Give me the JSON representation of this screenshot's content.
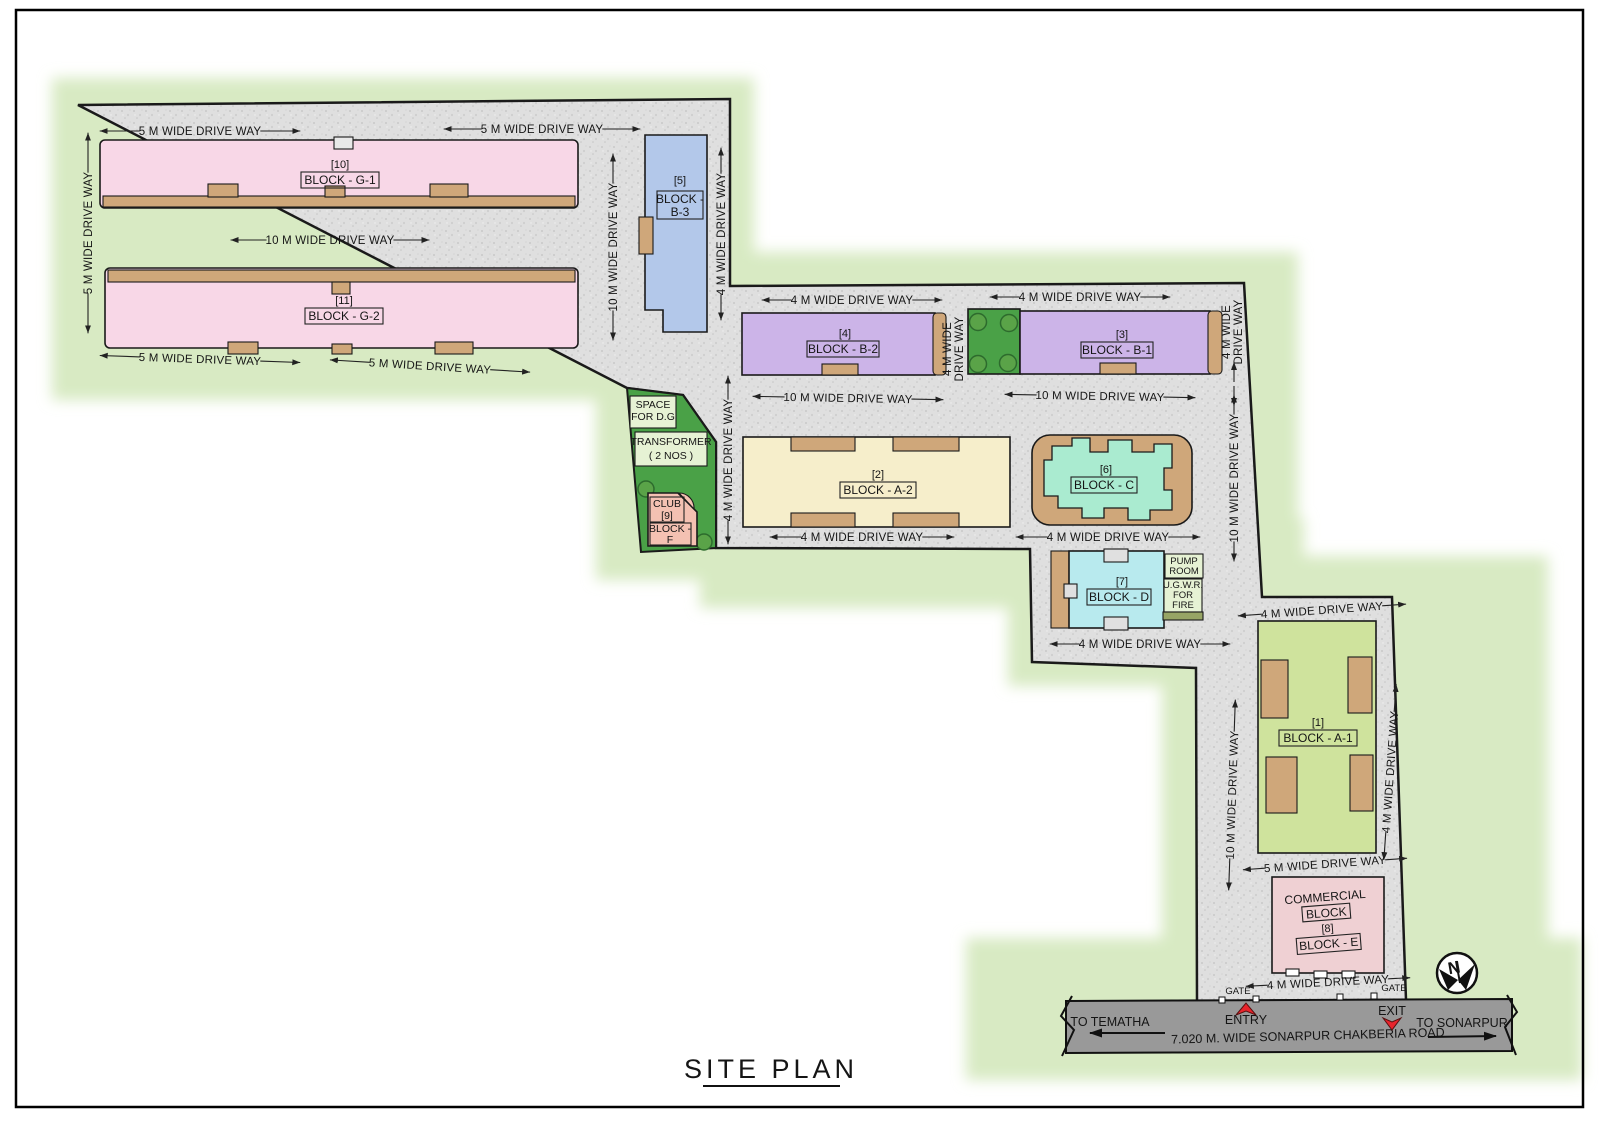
{
  "title": "SITE PLAN",
  "compass": {
    "north": "N"
  },
  "road": {
    "name": "7.020 M. WIDE SONARPUR CHAKBERIA ROAD",
    "to_left": "TO TEMATHA",
    "to_right": "TO SONARPUR",
    "entry": "ENTRY",
    "exit": "EXIT",
    "gate": "GATE"
  },
  "blocks": [
    {
      "key": "g1",
      "number": "[10]",
      "name": "BLOCK - G-1",
      "color": "#f8d7e7"
    },
    {
      "key": "g2",
      "number": "[11]",
      "name": "BLOCK - G-2",
      "color": "#f8d7e7"
    },
    {
      "key": "b3",
      "number": "[5]",
      "name_line1": "BLOCK -",
      "name_line2": "B-3",
      "color": "#b3c8ea"
    },
    {
      "key": "b2",
      "number": "[4]",
      "name": "BLOCK - B-2",
      "color": "#ccb4e8"
    },
    {
      "key": "b1",
      "number": "[3]",
      "name": "BLOCK - B-1",
      "color": "#ccb4e8"
    },
    {
      "key": "a2",
      "number": "[2]",
      "name": "BLOCK - A-2",
      "color": "#f6eecb"
    },
    {
      "key": "c",
      "number": "[6]",
      "name": "BLOCK - C",
      "color": "#aaebd0"
    },
    {
      "key": "d",
      "number": "[7]",
      "name": "BLOCK - D",
      "color": "#b8eaee"
    },
    {
      "key": "a1",
      "number": "[1]",
      "name": "BLOCK - A-1",
      "color": "#cfe39d"
    },
    {
      "key": "e",
      "heading": "COMMERCIAL",
      "subheading": "BLOCK",
      "number": "[8]",
      "name": "BLOCK - E",
      "color": "#efd0d3"
    },
    {
      "key": "f",
      "club": "CLUB",
      "number": "[9]",
      "name_line1": "BLOCK -",
      "name_line2": "F",
      "color": "#f4c1b2"
    }
  ],
  "facilities": {
    "space_dg": [
      "SPACE",
      "FOR D.G"
    ],
    "transformer": [
      "TRANSFORMER",
      "( 2 NOS )"
    ],
    "pump_room": [
      "PUMP",
      "ROOM"
    ],
    "ugwr": [
      "U.G.W.R.",
      "FOR",
      "FIRE"
    ]
  },
  "driveways": [
    {
      "t": "5 M WIDE DRIVE WAY",
      "x": 200,
      "y": 131,
      "r": 0,
      "a": 40
    },
    {
      "t": "5 M WIDE DRIVE WAY",
      "x": 542,
      "y": 129,
      "r": 0,
      "a": 38
    },
    {
      "t": "5 M WIDE DRIVE WAY",
      "x": 88,
      "y": 233,
      "r": -90,
      "a": 40
    },
    {
      "t": "10 M WIDE DRIVE WAY",
      "x": 330,
      "y": 240,
      "r": 0,
      "a": 36
    },
    {
      "t": "5 M WIDE DRIVE WAY",
      "x": 200,
      "y": 359,
      "r": 2,
      "a": 40
    },
    {
      "t": "5 M WIDE DRIVE WAY",
      "x": 430,
      "y": 366,
      "r": 3.5,
      "a": 40
    },
    {
      "t": "10 M WIDE DRIVE WAY",
      "x": 613,
      "y": 247,
      "r": -90,
      "a": 30
    },
    {
      "t": "4 M WIDE DRIVE WAY",
      "x": 721,
      "y": 234,
      "r": -90,
      "a": 26
    },
    {
      "t": "4 M WIDE DRIVE WAY",
      "x": 852,
      "y": 300,
      "r": 0,
      "a": 30
    },
    {
      "t": "4 M WIDE DRIVE WAY",
      "x": 1080,
      "y": 297,
      "r": 0,
      "a": 30
    },
    {
      "t": "4 M WIDE\nDRIVE WAY",
      "x": 953,
      "y": 349,
      "r": -90,
      "a": 0,
      "fs": 10.5
    },
    {
      "t": "4 M WIDE\nDRIVE WAY",
      "x": 1232,
      "y": 332,
      "r": -90,
      "a": 0,
      "fs": 10.5
    },
    {
      "t": "",
      "x": 1234,
      "y": 384,
      "r": -90,
      "a": 20
    },
    {
      "t": "10 M WIDE DRIVE WAY",
      "x": 848,
      "y": 398,
      "r": 1,
      "a": 32
    },
    {
      "t": "10 M WIDE DRIVE WAY",
      "x": 1100,
      "y": 396,
      "r": 1,
      "a": 32
    },
    {
      "t": "4 M WIDE DRIVE WAY",
      "x": 728,
      "y": 460,
      "r": -90,
      "a": 24
    },
    {
      "t": "10 M WIDE DRIVE WAY",
      "x": 1234,
      "y": 478,
      "r": -90,
      "a": 20
    },
    {
      "t": "4 M WIDE DRIVE WAY",
      "x": 862,
      "y": 537,
      "r": 0,
      "a": 32
    },
    {
      "t": "4 M WIDE DRIVE WAY",
      "x": 1108,
      "y": 537,
      "r": 0,
      "a": 32
    },
    {
      "t": "4 M WIDE DRIVE WAY",
      "x": 1140,
      "y": 644,
      "r": 0,
      "a": 30
    },
    {
      "t": "4 M WIDE DRIVE WAY",
      "x": 1322,
      "y": 610,
      "r": -4,
      "a": 24
    },
    {
      "t": "10 M WIDE DRIVE WAY",
      "x": 1232,
      "y": 795,
      "r": -88,
      "a": 32
    },
    {
      "t": "4 M WIDE DRIVE WAY",
      "x": 1390,
      "y": 772,
      "r": -86,
      "a": 28
    },
    {
      "t": "5 M WIDE DRIVE WAY",
      "x": 1325,
      "y": 864,
      "r": -4,
      "a": 22
    },
    {
      "t": "4 M WIDE DRIVE WAY",
      "x": 1328,
      "y": 982,
      "r": -3,
      "a": 22
    }
  ],
  "colors": {
    "paving": "#dedede",
    "buffer": "#d8eac3",
    "grass": "#4aa147",
    "tan": "#cfa77a",
    "pink": "#f8d7e7",
    "salmon": "#f4c1b2",
    "blue": "#b3c8ea",
    "purple": "#ccb4e8",
    "cream": "#f6eecb",
    "mint": "#aaebd0",
    "cyan": "#b8eaee",
    "lime": "#cfe39d",
    "pink_commercial": "#efd0d3",
    "utility_box": "#e6f2d4",
    "road": "#999999",
    "entry_exit_arrow": "#e8242c",
    "outline": "#1a1a1a"
  }
}
